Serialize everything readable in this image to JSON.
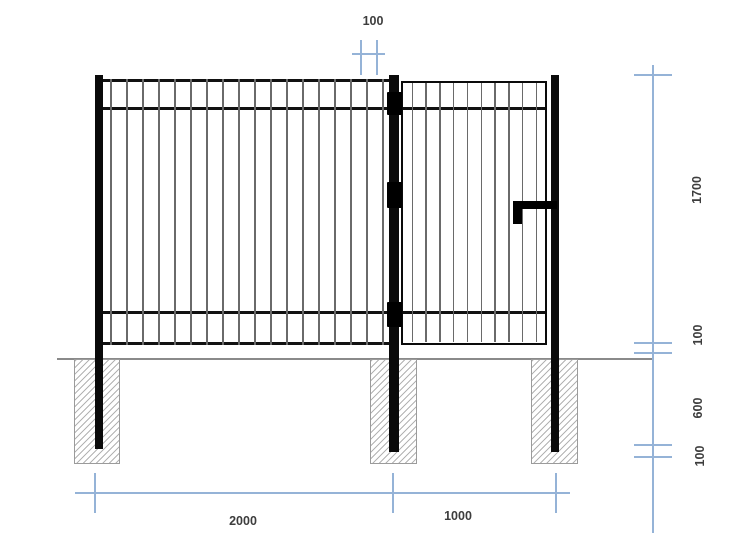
{
  "drawing": {
    "title": "fence-with-gate-elevation",
    "dimensions": {
      "top": {
        "label": "100"
      },
      "right": [
        {
          "label": "1700"
        },
        {
          "label": "100"
        },
        {
          "label": "600"
        },
        {
          "label": "100"
        }
      ],
      "bottom": [
        {
          "label": "2000"
        },
        {
          "label": "1000"
        }
      ]
    },
    "fence": {
      "panel_bar_count": 18,
      "gate_bar_count": 10,
      "hinge_count": 3,
      "footing_count": 3
    },
    "colors": {
      "dimension_line": "#95b3d7",
      "label_text": "#3d3d3d",
      "structure": "#0a0a0a",
      "picket_bar": "#6a6a6a",
      "ground_line": "#8a8a8a",
      "footing_hatch": "#b3b3b3"
    }
  }
}
